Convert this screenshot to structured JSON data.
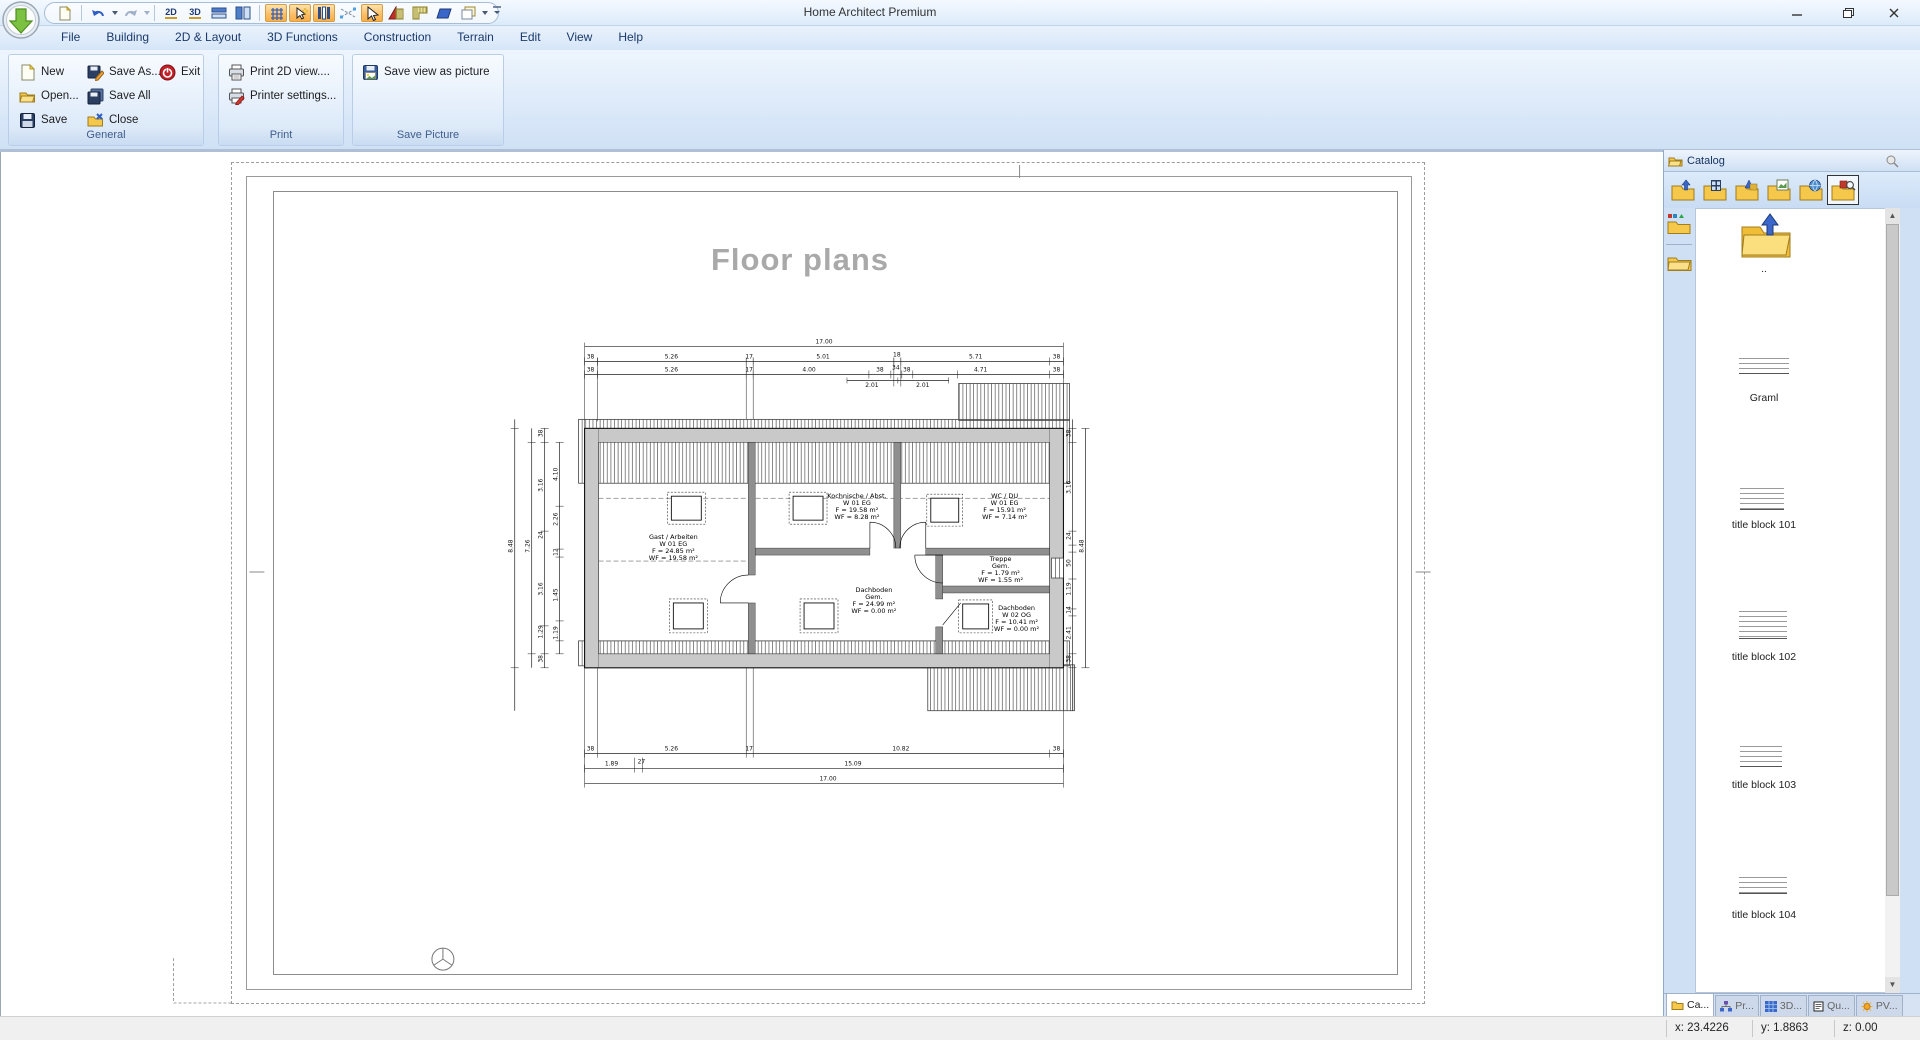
{
  "window": {
    "title": "Home Architect Premium"
  },
  "colors": {
    "ribbon_bg": "#dce9f8",
    "toggle_highlight": "#fbbd64",
    "tab_text": "#1b3a6b",
    "plan_wall_gray": "#c9c9c9",
    "title_gray": "#a9a9a9"
  },
  "qat": {
    "glyph_2d": "2D",
    "glyph_3d": "3D"
  },
  "ribbon": {
    "tabs": [
      {
        "label": "File"
      },
      {
        "label": "Building"
      },
      {
        "label": "2D & Layout"
      },
      {
        "label": "3D Functions"
      },
      {
        "label": "Construction"
      },
      {
        "label": "Terrain"
      },
      {
        "label": "Edit"
      },
      {
        "label": "View"
      },
      {
        "label": "Help"
      }
    ],
    "groups": [
      {
        "label": "General",
        "items": [
          {
            "label": "New"
          },
          {
            "label": "Open..."
          },
          {
            "label": "Save"
          },
          {
            "label": "Save As..."
          },
          {
            "label": "Save All"
          },
          {
            "label": "Close"
          },
          {
            "label": "Exit"
          }
        ]
      },
      {
        "label": "Print",
        "items": [
          {
            "label": "Print 2D view...."
          },
          {
            "label": "Printer settings..."
          }
        ]
      },
      {
        "label": "Save Picture",
        "items": [
          {
            "label": "Save view as picture"
          }
        ]
      }
    ]
  },
  "canvas": {
    "title": "Floor plans"
  },
  "plan": {
    "rooms": [
      {
        "lines": [
          "Gast / Arbeiten",
          "W 01 EG",
          "F = 24.85 m²",
          "WF = 19.58 m²"
        ]
      },
      {
        "lines": [
          "Kochnische / Abst.",
          "W 01 EG",
          "F = 19.58 m²",
          "WF = 8.28 m²"
        ]
      },
      {
        "lines": [
          "WC / DU",
          "W 01 EG",
          "F = 15.91 m²",
          "WF = 7.14 m²"
        ]
      },
      {
        "lines": [
          "Treppe",
          "Gem.",
          "F = 1.79 m²",
          "WF = 1.55 m²"
        ]
      },
      {
        "lines": [
          "Dachboden",
          "Gem.",
          "F = 24.99 m²",
          "WF = 0.00 m²"
        ]
      },
      {
        "lines": [
          "Dachboden",
          "W 02 OG",
          "F = 10.41 m²",
          "WF = 0.00 m²"
        ]
      }
    ],
    "dims": {
      "top_total": "17.00",
      "top_row2": [
        "38",
        "5.26",
        "17",
        "5.01",
        "18",
        "5.71",
        "38"
      ],
      "top_row3": [
        "38",
        "5.26",
        "17",
        "4.00",
        "38",
        "34",
        "38",
        "4.71",
        "38"
      ],
      "top_sub": [
        "2.01",
        "2.01"
      ],
      "bottom_row1": [
        "38",
        "5.26",
        "17",
        "10.82",
        "38"
      ],
      "bottom_row2": [
        "1.89",
        "27",
        "15.09"
      ],
      "bottom_total": "17.00",
      "left_col1": [
        "38",
        "3.16",
        "24",
        "3.16",
        "1.29",
        "38"
      ],
      "left_col2": [
        "4.10",
        "2.26",
        "12",
        "1.45",
        "1.19"
      ],
      "left_totals": [
        "7.26",
        "8.48"
      ],
      "right_col": [
        "38",
        "3.16",
        "24",
        "50",
        "1.19",
        "14",
        "2.41",
        "38"
      ],
      "right_total": "8.48"
    }
  },
  "catalog": {
    "title": "Catalog",
    "up_label": "..",
    "items": [
      {
        "label": "Graml"
      },
      {
        "label": "title block 101"
      },
      {
        "label": "title block 102"
      },
      {
        "label": "title block 103"
      },
      {
        "label": "title block 104"
      }
    ],
    "tabs": [
      {
        "label": "Ca..."
      },
      {
        "label": "Pr..."
      },
      {
        "label": "3D..."
      },
      {
        "label": "Qu..."
      },
      {
        "label": "PV..."
      }
    ]
  },
  "statusbar": {
    "x": "x: 23.4226",
    "y": "y: 1.8863",
    "z": "z: 0.00"
  }
}
